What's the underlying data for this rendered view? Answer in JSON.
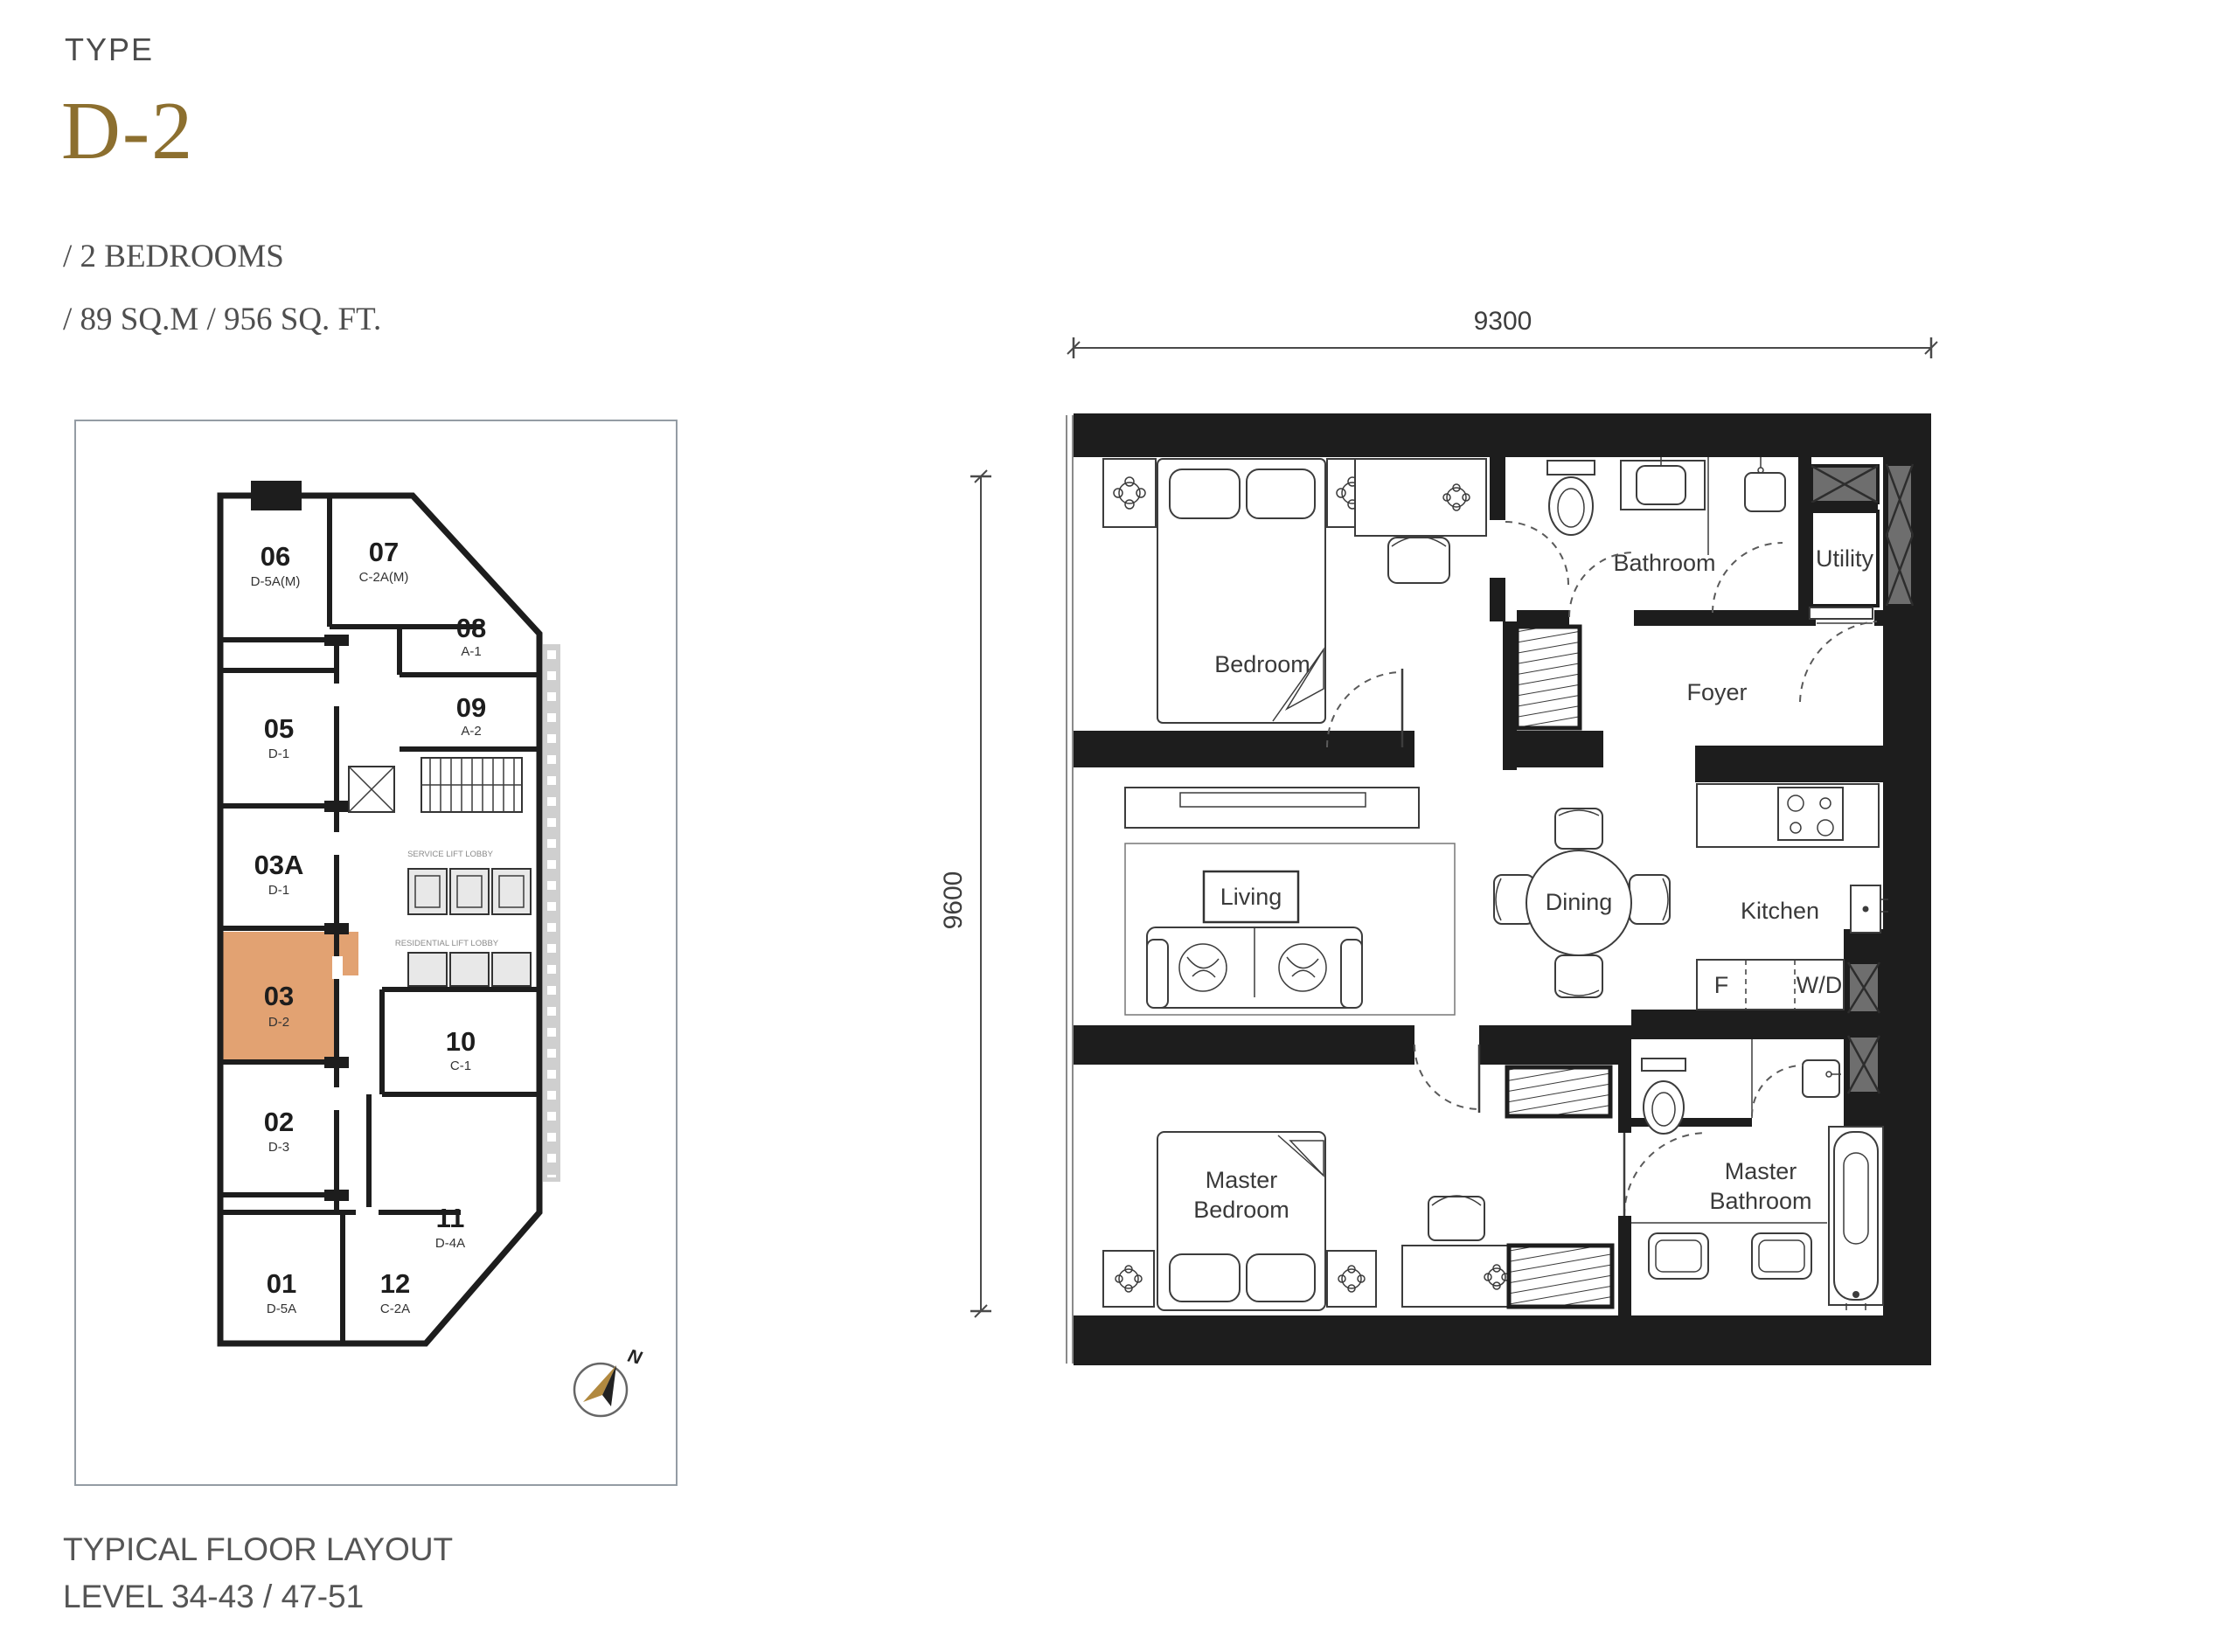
{
  "header": {
    "type_label": "TYPE",
    "unit_code": "D-2",
    "bedrooms_line": "/ 2 BEDROOMS",
    "area_line": "/ 89 SQ.M / 956 SQ. FT."
  },
  "footer": {
    "layout_title": "TYPICAL FLOOR LAYOUT",
    "levels_line": "LEVEL 34-43 / 47-51"
  },
  "colors": {
    "accent_gold": "#8C6F2F",
    "text_dark": "#4A4A4A",
    "wall_black": "#1D1D1D",
    "highlight_orange": "#E2A272",
    "shaft_gray": "#6E6E6E"
  },
  "key_plan": {
    "compass_label": "N",
    "service_lobby_label": "SERVICE LIFT LOBBY",
    "residential_lobby_label": "RESIDENTIAL LIFT LOBBY",
    "highlighted_unit": "03",
    "units": [
      {
        "no": "06",
        "code": "D-5A(M)"
      },
      {
        "no": "07",
        "code": "C-2A(M)"
      },
      {
        "no": "08",
        "code": "A-1"
      },
      {
        "no": "09",
        "code": "A-2"
      },
      {
        "no": "05",
        "code": "D-1"
      },
      {
        "no": "03A",
        "code": "D-1"
      },
      {
        "no": "03",
        "code": "D-2"
      },
      {
        "no": "02",
        "code": "D-3"
      },
      {
        "no": "10",
        "code": "C-1"
      },
      {
        "no": "11",
        "code": "D-4A"
      },
      {
        "no": "01",
        "code": "D-5A"
      },
      {
        "no": "12",
        "code": "C-2A"
      }
    ]
  },
  "floor_plan": {
    "dim_top": "9300",
    "dim_left": "9600",
    "rooms": {
      "bedroom": "Bedroom",
      "bathroom": "Bathroom",
      "utility": "Utility",
      "foyer": "Foyer",
      "living": "Living",
      "dining": "Dining",
      "kitchen": "Kitchen",
      "master_line1": "Master",
      "master_bedroom_line2": "Bedroom",
      "master_bathroom_line2": "Bathroom",
      "fridge": "F",
      "washer_dryer": "W/D"
    }
  }
}
